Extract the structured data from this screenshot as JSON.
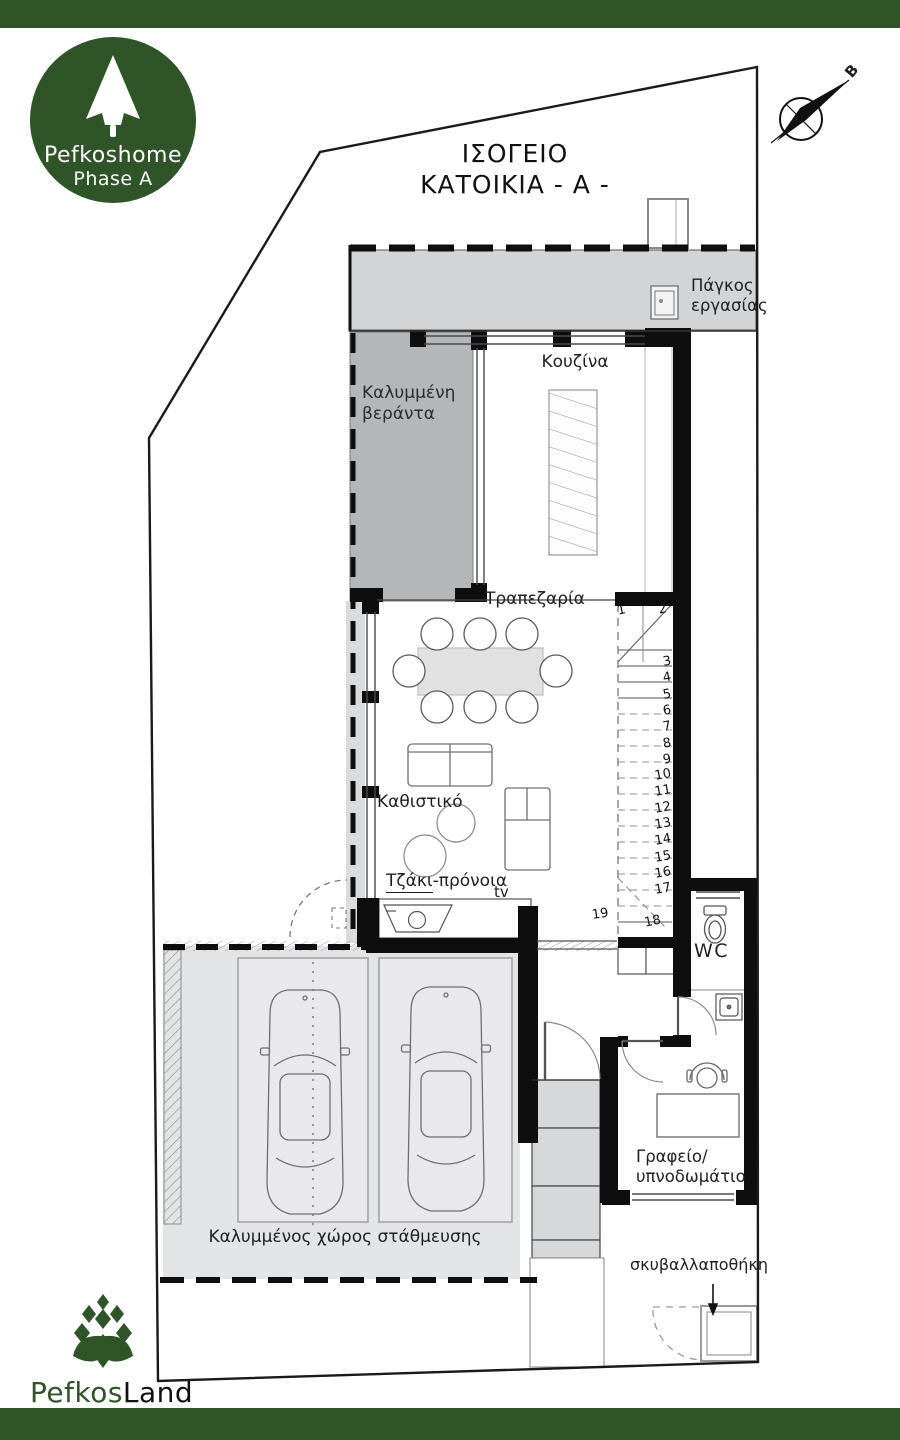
{
  "colors": {
    "brand_green": "#2e5427",
    "wall_black": "#0e0e0e"
  },
  "branding": {
    "logo_top_line1": "Pefkoshome",
    "logo_top_line2": "Phase A",
    "logo_bottom_part1": "Pefkos",
    "logo_bottom_part2": "Land"
  },
  "compass": {
    "north_label": "B"
  },
  "title": {
    "line1": "ΙΣΟΓΕΙΟ",
    "line2": "ΚΑΤΟΙΚΙΑ - Α -"
  },
  "labels": {
    "work_bench_line1": "Πάγκος",
    "work_bench_line2": "εργασίας",
    "kitchen": "Κουζίνα",
    "veranda_line1": "Καλυμμένη",
    "veranda_line2": "βεράντα",
    "dining": "Τραπεζαρία",
    "living": "Καθιστικό",
    "fireplace_underlined": "Τζάκι",
    "fireplace_rest": "-πρόνοια",
    "tv": "tv",
    "wc": "WC",
    "office_line1": "Γραφείο/",
    "office_line2": "υπνοδωμάτιο",
    "parking": "Καλυμμένος χώρος στάθμευσης",
    "garbage": "σκυβαλλαποθήκη"
  },
  "stairs": {
    "steps": [
      "1",
      "2",
      "3",
      "4",
      "5",
      "6",
      "7",
      "8",
      "9",
      "10",
      "11",
      "12",
      "13",
      "14",
      "15",
      "16",
      "17",
      "18",
      "19"
    ]
  }
}
